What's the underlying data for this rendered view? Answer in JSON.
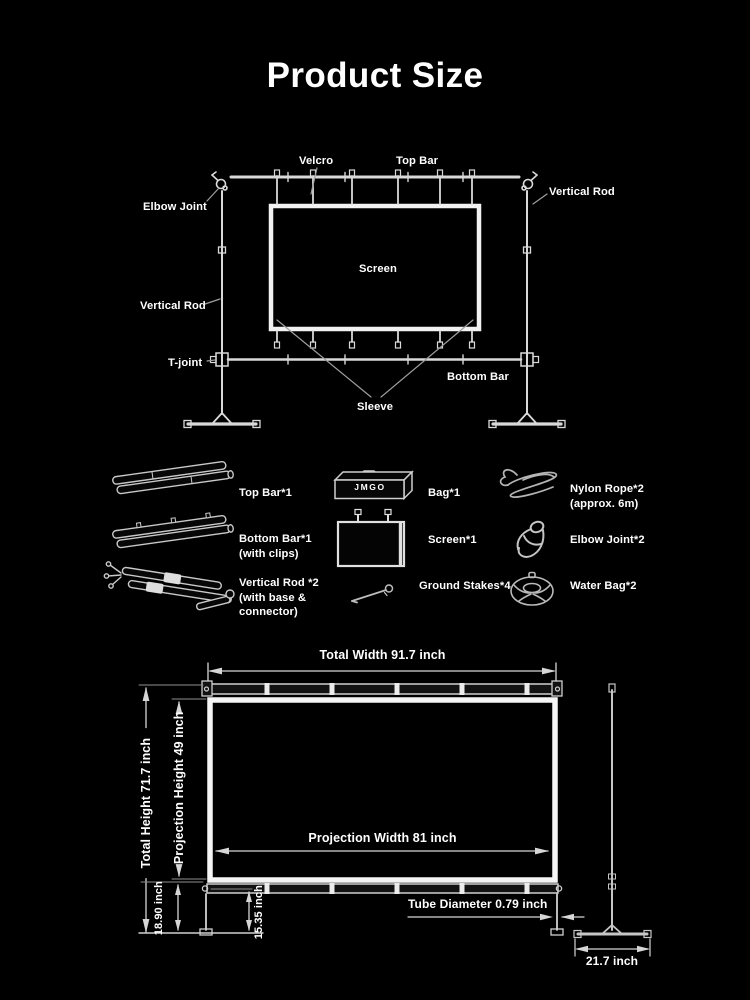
{
  "title": "Product Size",
  "assembly": {
    "velcro": "Velcro",
    "top_bar": "Top Bar",
    "vertical_rod_right": "Vertical Rod",
    "elbow_joint": "Elbow Joint",
    "screen": "Screen",
    "vertical_rod_left": "Vertical Rod",
    "t_joint": "T-joint",
    "bottom_bar": "Bottom Bar",
    "sleeve": "Sleeve"
  },
  "parts": {
    "top_bar": {
      "line1": "Top Bar*1"
    },
    "bag": {
      "line1": "Bag*1",
      "logo": "JMGO"
    },
    "nylon_rope": {
      "line1": "Nylon Rope*2",
      "line2": "(approx. 6m)"
    },
    "bottom_bar": {
      "line1": "Bottom Bar*1",
      "line2": "(with clips)"
    },
    "screen": {
      "line1": "Screen*1"
    },
    "elbow_joint": {
      "line1": "Elbow Joint*2"
    },
    "vertical_rod": {
      "line1": "Vertical Rod *2",
      "line2": "(with base &",
      "line3": "connector)"
    },
    "ground_stakes": {
      "line1": "Ground Stakes*4"
    },
    "water_bag": {
      "line1": "Water Bag*2"
    }
  },
  "dimensions": {
    "total_width": "Total Width 91.7 inch",
    "projection_width": "Projection Width 81 inch",
    "total_height": "Total Height 71.7 inch",
    "projection_height": "Projection Height 49 inch",
    "screen_bottom_to_ground": "18.90 inch",
    "bar_to_ground": "15.35 inch",
    "tube_diameter": "Tube Diameter 0.79 inch",
    "base_width": "21.7 inch"
  },
  "colors": {
    "background": "#000000",
    "text": "#ffffff",
    "line": "#e8e8e8"
  }
}
